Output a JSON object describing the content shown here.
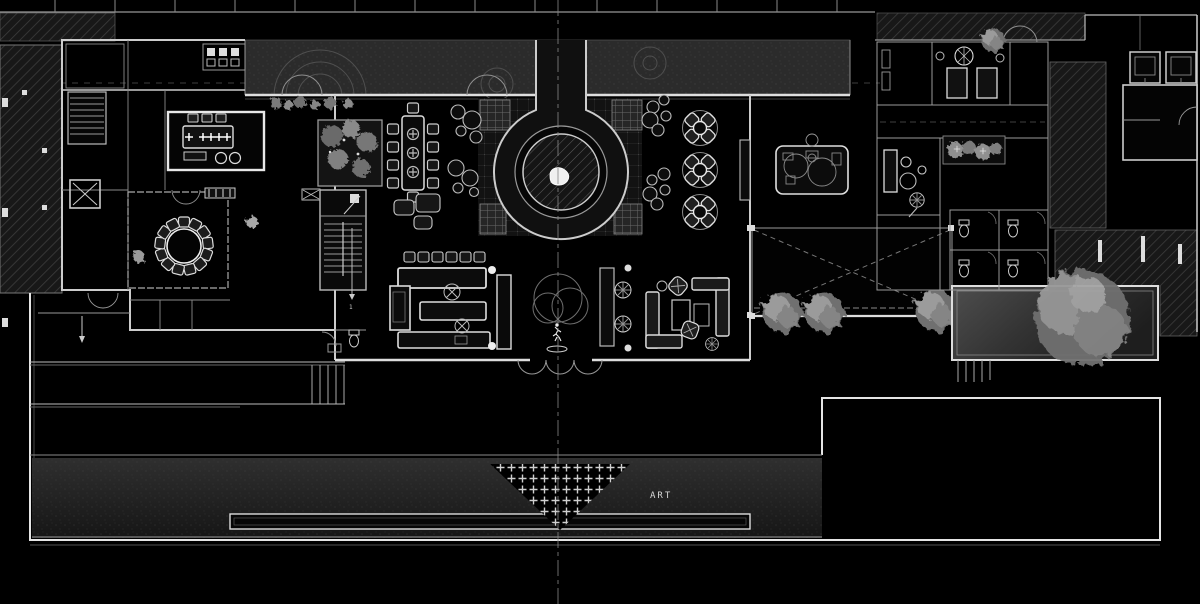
{
  "labels": {
    "art": "ART",
    "stair_number": "1"
  },
  "palette": {
    "bg": "#000000",
    "wall": "#e8e8e8",
    "wall-dim": "#9a9a9a",
    "line-faint": "#4a4a4a",
    "driveway": "#2b2b2b",
    "tree": "#8d8d8d",
    "text": "#d8d8d8"
  },
  "plan": {
    "type": "architectural-floor-plan",
    "style": "white-line CAD presentation plan on black",
    "features": [
      {
        "name": "entry-driveway",
        "kind": "paving band with arc patterns"
      },
      {
        "name": "north-entry-statue",
        "kind": "sculpture on centerline"
      },
      {
        "name": "keyhole-plaza",
        "kind": "circular water feature with hatched basin and sculpture"
      },
      {
        "name": "tiled-apron",
        "kind": "grid-paved floor around water feature"
      },
      {
        "name": "conference-room",
        "kind": "meeting table with chairs and place settings"
      },
      {
        "name": "private-dining-room",
        "kind": "round table with 13 chairs"
      },
      {
        "name": "long-dining-table",
        "kind": "10-seat table"
      },
      {
        "name": "lounge-clusters",
        "kind": "grouped round cocktail tables"
      },
      {
        "name": "bar-counter",
        "kind": "U-shaped bar with 6 stools"
      },
      {
        "name": "stair-core-west",
        "kind": "double-run stair with WC"
      },
      {
        "name": "stair-core-left-wing",
        "kind": "stair and elevator"
      },
      {
        "name": "x-dining-tables",
        "kind": "three round tables with 4 chairs each"
      },
      {
        "name": "buffet-table",
        "kind": "rounded display table"
      },
      {
        "name": "south-lounge",
        "kind": "L-sofas, coffee tables, wicker chairs"
      },
      {
        "name": "south-entry-statue",
        "kind": "sculpture with tree canopy on centerline"
      },
      {
        "name": "courtyard",
        "kind": "open court marked with dashed X"
      },
      {
        "name": "courtyard-trees",
        "kind": "row of three trees"
      },
      {
        "name": "reflecting-pool-east",
        "kind": "rectangular pool with large tree"
      },
      {
        "name": "guest-rooms-east",
        "kind": "rooms, planting strip, WC block"
      },
      {
        "name": "elevator-shafts-east",
        "kind": "two lift cores"
      },
      {
        "name": "adjacent-structures",
        "kind": "diagonal-hatched existing buildings"
      },
      {
        "name": "south-terrace",
        "kind": "stepped terrace with ramp arrow"
      },
      {
        "name": "lawn-band",
        "kind": "gray landscape band"
      },
      {
        "name": "art-water-feature",
        "kind": "stepped triangle of plus-shaped pavers labeled ART"
      },
      {
        "name": "linear-pool-south",
        "kind": "long thin reflecting pool"
      },
      {
        "name": "centerline",
        "kind": "vertical dashed axis"
      }
    ]
  }
}
